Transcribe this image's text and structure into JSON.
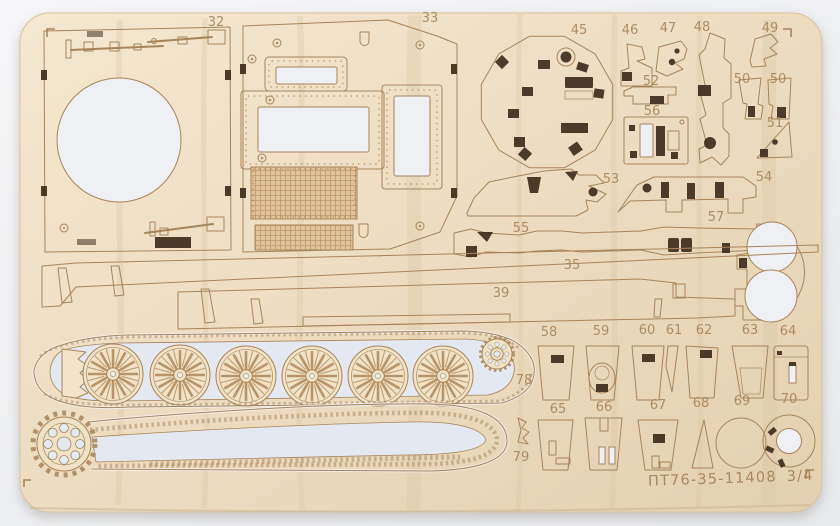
{
  "colors": {
    "plywood": "#eeddc1",
    "plywood_light": "#f2e4ca",
    "engrave": "#a8845a",
    "cut": "#3f2d1c",
    "hole": "#eef0f4",
    "track_hole": "#e4e8f0",
    "background": "#eff0f2"
  },
  "labels": {
    "l32": "32",
    "l33": "33",
    "l35": "35",
    "l39": "39",
    "l45": "45",
    "l46": "46",
    "l47": "47",
    "l48": "48",
    "l49": "49",
    "l50a": "50",
    "l50b": "50",
    "l51": "51",
    "l52": "52",
    "l53": "53",
    "l54": "54",
    "l55": "55",
    "l56": "56",
    "l57": "57",
    "l58": "58",
    "l59": "59",
    "l60": "60",
    "l61": "61",
    "l62": "62",
    "l63": "63",
    "l64": "64",
    "l65": "65",
    "l66": "66",
    "l67": "67",
    "l68": "68",
    "l69": "69",
    "l70": "70",
    "l78": "78",
    "l79": "79"
  },
  "footer": {
    "code": "ПТ76-35-11408",
    "sheet_number": "3/4"
  }
}
